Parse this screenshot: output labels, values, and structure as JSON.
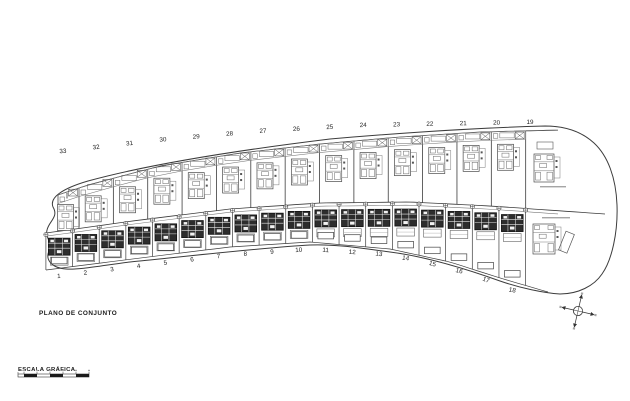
{
  "labels": {
    "title": "PLANO DE CONJUNTO",
    "scale": "ESCALA GRÁFICA"
  },
  "top_row": {
    "plot_numbers": [
      "33",
      "32",
      "31",
      "30",
      "29",
      "28",
      "27",
      "26",
      "25",
      "24",
      "23",
      "22",
      "21",
      "20",
      "19"
    ]
  },
  "bottom_row": {
    "plot_numbers": [
      "1",
      "2",
      "3",
      "4",
      "5",
      "6",
      "7",
      "8",
      "9",
      "10",
      "11",
      "12",
      "13",
      "14",
      "15",
      "16",
      "17",
      "18"
    ]
  },
  "colors": {
    "line": "#3c3c3c",
    "line_light": "#7a7a7a",
    "line_faint": "#9f9f9f",
    "dark_fill": "#2d2d2d",
    "white": "#ffffff",
    "text": "#1c1c1c",
    "smudge": "#a5a5a5",
    "background": "#ffffff"
  },
  "scale_bar": {
    "segments": 5
  },
  "compass": {
    "arms": 4
  }
}
